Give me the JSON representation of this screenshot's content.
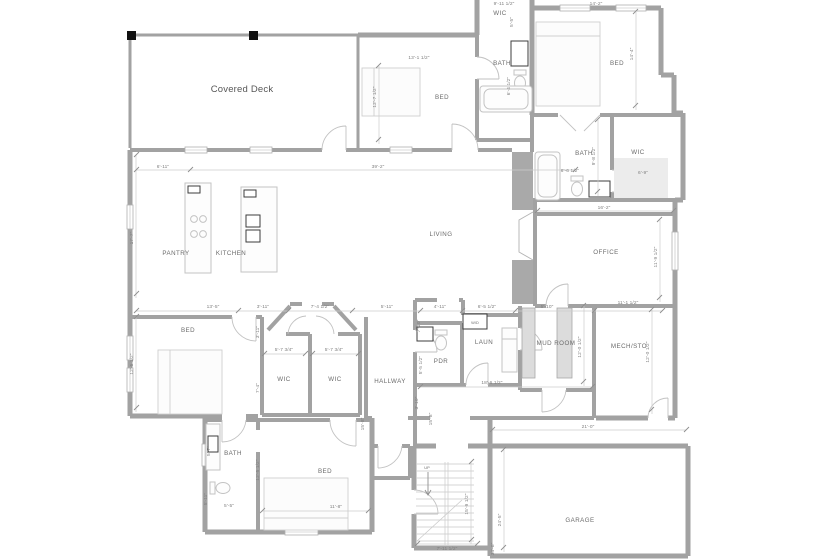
{
  "plan": {
    "title": "Main floor plan",
    "colors": {
      "wall": "#a2a2a2",
      "dim_line": "#cccccc",
      "dim_text": "#7f7f7f",
      "room_text": "#6b6b6b",
      "fixture": "#c3c3c3",
      "post": "#111111",
      "background": "#ffffff"
    },
    "rooms": [
      {
        "id": "covered-deck",
        "label": "Covered Deck"
      },
      {
        "id": "wic-top",
        "label": "WIC"
      },
      {
        "id": "bath-top",
        "label": "BATH"
      },
      {
        "id": "bed-top",
        "label": "BED"
      },
      {
        "id": "bed-ne",
        "label": "BED"
      },
      {
        "id": "bath-east",
        "label": "BATH"
      },
      {
        "id": "wic-east",
        "label": "WIC"
      },
      {
        "id": "pantry",
        "label": "PANTRY"
      },
      {
        "id": "kitchen",
        "label": "KITCHEN"
      },
      {
        "id": "living",
        "label": "LIVING"
      },
      {
        "id": "office",
        "label": "OFFICE"
      },
      {
        "id": "bed-west",
        "label": "BED"
      },
      {
        "id": "wic-1",
        "label": "WIC"
      },
      {
        "id": "wic-2",
        "label": "WIC"
      },
      {
        "id": "hallway",
        "label": "HALLWAY"
      },
      {
        "id": "pdr",
        "label": "PDR"
      },
      {
        "id": "laun",
        "label": "LAUN"
      },
      {
        "id": "wd",
        "label": "W/D"
      },
      {
        "id": "mud-room",
        "label": "MUD ROOM"
      },
      {
        "id": "mech-sto",
        "label": "MECH/STO"
      },
      {
        "id": "bath-south",
        "label": "BATH"
      },
      {
        "id": "bed-south",
        "label": "BED"
      },
      {
        "id": "garage",
        "label": "GARAGE"
      },
      {
        "id": "up",
        "label": "UP"
      }
    ],
    "dims": [
      {
        "t": "6'-11\"",
        "o": "h"
      },
      {
        "t": "17'-7\"",
        "o": "v"
      },
      {
        "t": "39'-2\"",
        "o": "h"
      },
      {
        "t": "9'-11 1/2\"",
        "o": "h"
      },
      {
        "t": "5'-5\"",
        "o": "v"
      },
      {
        "t": "13'-1 1/2\"",
        "o": "h"
      },
      {
        "t": "12'-7 1/2\"",
        "o": "v"
      },
      {
        "t": "6'-4 1/2\"",
        "o": "v"
      },
      {
        "t": "14'-2\"",
        "o": "h"
      },
      {
        "t": "14'-4\"",
        "o": "v"
      },
      {
        "t": "9'-8 1/2\"",
        "o": "v"
      },
      {
        "t": "6'-6 1/2\"",
        "o": "h"
      },
      {
        "t": "6'-9\"",
        "o": "h"
      },
      {
        "t": "16'-2\"",
        "o": "h"
      },
      {
        "t": "11'-9 1/2\"",
        "o": "v"
      },
      {
        "t": "13'-5\"",
        "o": "h"
      },
      {
        "t": "3'-11\"",
        "o": "h"
      },
      {
        "t": "7'-4 1/2\"",
        "o": "h"
      },
      {
        "t": "5'-11\"",
        "o": "h"
      },
      {
        "t": "4'-11\"",
        "o": "h"
      },
      {
        "t": "6'-5 1/2\"",
        "o": "h"
      },
      {
        "t": "5'-10\"",
        "o": "h"
      },
      {
        "t": "11'-1 1/2\"",
        "o": "h"
      },
      {
        "t": "3'-11\"",
        "o": "v"
      },
      {
        "t": "7'-10\"",
        "o": "v"
      },
      {
        "t": "12'-5 1/2\"",
        "o": "v"
      },
      {
        "t": "5'-7 3/4\"",
        "o": "h"
      },
      {
        "t": "5'-7 3/4\"",
        "o": "h"
      },
      {
        "t": "7'-4\"",
        "o": "v"
      },
      {
        "t": "5'-5 1/2\"",
        "o": "v"
      },
      {
        "t": "12'-0 1/2\"",
        "o": "v"
      },
      {
        "t": "12'-0 1/2\"",
        "o": "v"
      },
      {
        "t": "18'-6 1/2\"",
        "o": "h"
      },
      {
        "t": "3'-10\"",
        "o": "v"
      },
      {
        "t": "5'-7\"",
        "o": "v"
      },
      {
        "t": "5'-11\"",
        "o": "v"
      },
      {
        "t": "5'-5\"",
        "o": "h"
      },
      {
        "t": "12'-5 1/2\"",
        "o": "v"
      },
      {
        "t": "11'-8\"",
        "o": "h"
      },
      {
        "t": "15'-8\"",
        "o": "v"
      },
      {
        "t": "15'-8\"",
        "o": "v"
      },
      {
        "t": "15'-9 1/2\"",
        "o": "v"
      },
      {
        "t": "7'-11 1/2\"",
        "o": "h"
      },
      {
        "t": "24'-5\"",
        "o": "v"
      },
      {
        "t": "34'-8\"",
        "o": "v"
      },
      {
        "t": "21'-0\"",
        "o": "h"
      }
    ],
    "fixtures": [
      "deck-post",
      "window",
      "door-arc",
      "range-burners",
      "island-sink",
      "bathtub",
      "toilet",
      "vanity-sink",
      "bed",
      "washer",
      "wd-stack",
      "locker-bench",
      "fireplace",
      "stairs-up",
      "closet-shelf"
    ]
  }
}
